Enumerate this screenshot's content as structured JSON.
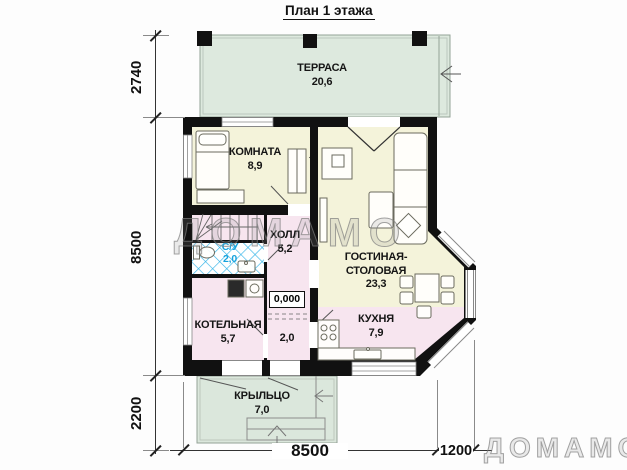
{
  "title": "План 1 этажа",
  "watermark": {
    "center": "ДОМАМО",
    "corner": "ДОМАМО"
  },
  "elevation_mark": "0,000",
  "dimensions": {
    "left_vertical": {
      "terrace": "2740",
      "house": "8500",
      "porch": "2200"
    },
    "bottom_horizontal": {
      "house": "8500",
      "bay": "1200"
    }
  },
  "rooms": {
    "terrace": {
      "name": "ТЕРРАСА",
      "area": "20,6"
    },
    "bedroom": {
      "name": "КОМНАТА",
      "area": "8,9"
    },
    "hall": {
      "name": "ХОЛЛ",
      "area": "5,2"
    },
    "wc": {
      "name": "С/У",
      "area": "2,0"
    },
    "living": {
      "name": "ГОСТИНАЯ-СТОЛОВАЯ",
      "area": "23,3"
    },
    "boiler": {
      "name": "КОТЕЛЬНАЯ",
      "area": "5,7"
    },
    "tambour": {
      "area": "2,0"
    },
    "kitchen": {
      "name": "КУХНЯ",
      "area": "7,9"
    },
    "porch": {
      "name": "КРЫЛЬЦО",
      "area": "7,0"
    }
  },
  "colors": {
    "outdoor_green": "#dde9de",
    "room_cream": "#f4f3da",
    "room_pink": "#f7e5ef",
    "wall": "#111111",
    "wc_hatch": "#35b4e8",
    "wc_label": "#17a3dd"
  }
}
